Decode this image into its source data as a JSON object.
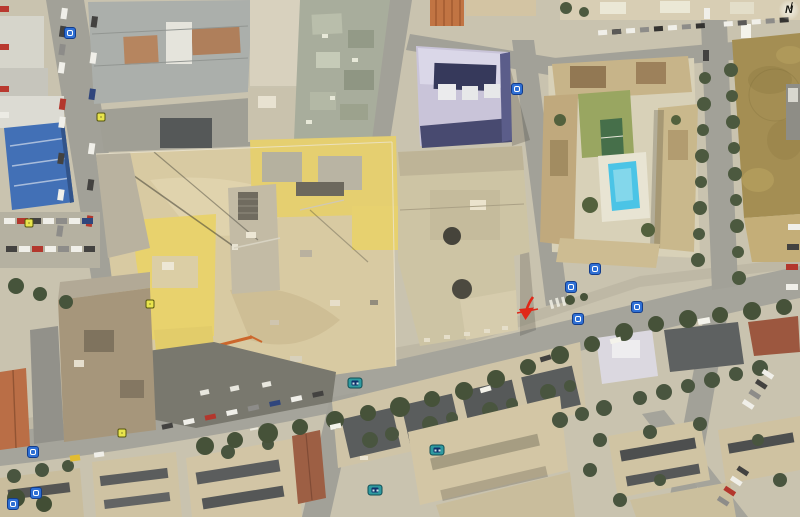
{
  "map": {
    "north_indicator": {
      "label": "N"
    },
    "annotation_arrow": {
      "x": 516,
      "y": 296,
      "color": "#e02818",
      "name": "red-arrow"
    },
    "marker_types": {
      "photo": "photo-placemark",
      "bus": "bus-stop-placemark",
      "junction": "signal-placemark"
    },
    "marker_colors": {
      "photo_bg": "#2e6fd4",
      "photo_border": "#123c8c",
      "photo_inner": "#ffffff",
      "bus_bg": "#2f9aa0",
      "bus_border": "#114c52",
      "bus_inner": "#10306a",
      "junction_bg": "#e8e44c",
      "junction_border": "#55550f",
      "junction_dot": "#26260e"
    },
    "markers": [
      {
        "type": "photo",
        "x": 571,
        "y": 287
      },
      {
        "type": "photo",
        "x": 578,
        "y": 319
      },
      {
        "type": "photo",
        "x": 595,
        "y": 269
      },
      {
        "type": "photo",
        "x": 637,
        "y": 307
      },
      {
        "type": "photo",
        "x": 517,
        "y": 89
      },
      {
        "type": "photo",
        "x": 33,
        "y": 452
      },
      {
        "type": "photo",
        "x": 36,
        "y": 493
      },
      {
        "type": "photo",
        "x": 13,
        "y": 504
      },
      {
        "type": "photo",
        "x": 70,
        "y": 33
      },
      {
        "type": "bus",
        "x": 355,
        "y": 383
      },
      {
        "type": "bus",
        "x": 437,
        "y": 450
      },
      {
        "type": "bus",
        "x": 375,
        "y": 490
      },
      {
        "type": "junction",
        "x": 101,
        "y": 117
      },
      {
        "type": "junction",
        "x": 29,
        "y": 223
      },
      {
        "type": "junction",
        "x": 150,
        "y": 304
      },
      {
        "type": "junction",
        "x": 122,
        "y": 433
      }
    ]
  }
}
